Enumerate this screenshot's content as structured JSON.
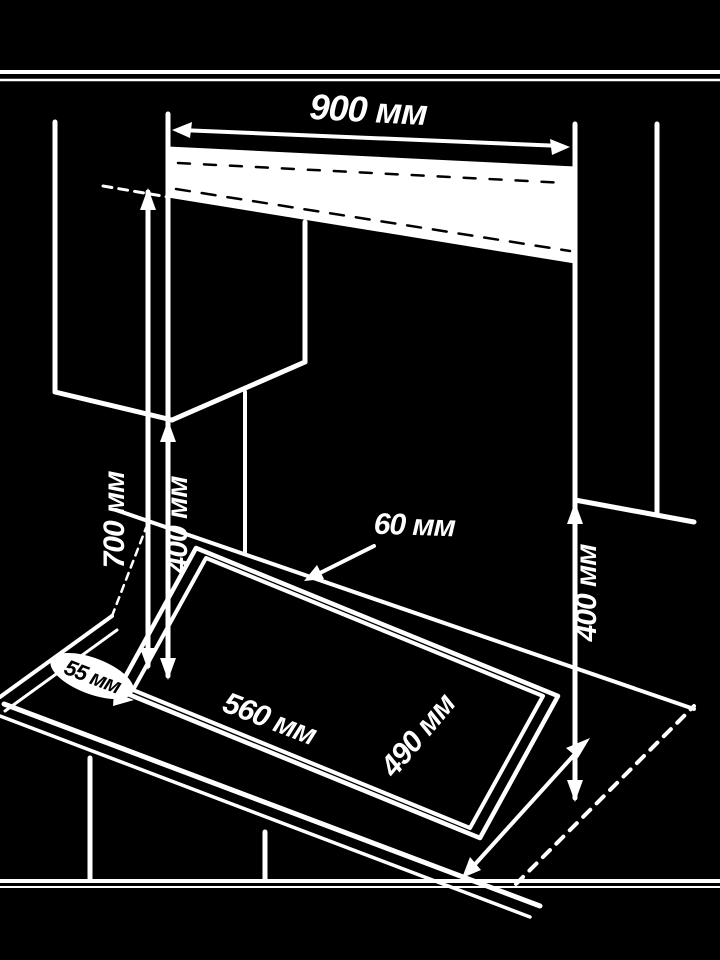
{
  "diagram": {
    "description": "Built-in hob installation clearance diagram (isometric line drawing, white on black)",
    "background_color": "#000000",
    "line_color": "#ffffff",
    "dimensions": {
      "hood_width": "900 мм",
      "rear_clearance": "60 мм",
      "hood_height_above_worktop": "700 мм",
      "left_cabinet_clearance": "400 мм",
      "right_cabinet_clearance": "400 мм",
      "cutout_width": "560 мм",
      "cutout_depth": "490 мм",
      "side_clearance": "55 мм"
    }
  }
}
